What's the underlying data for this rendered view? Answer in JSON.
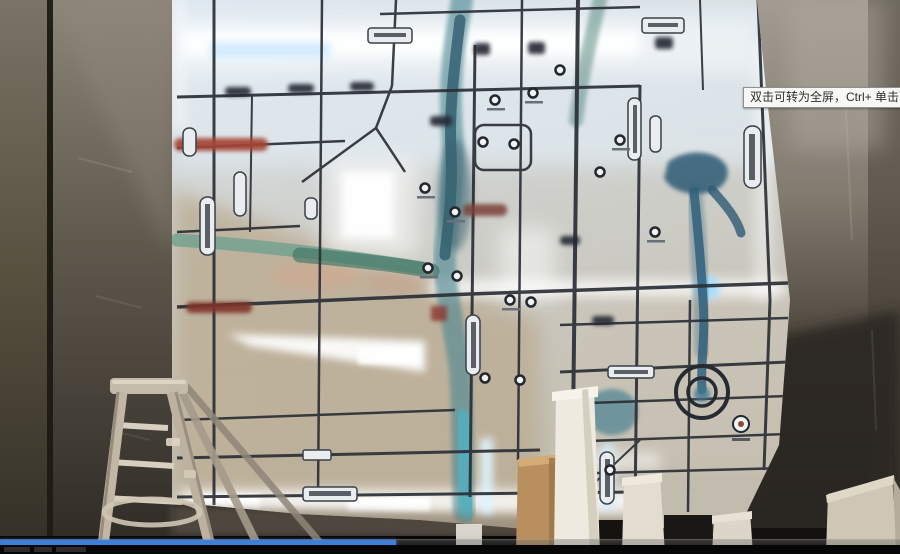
{
  "player": {
    "fullscreen_tooltip": "双击可转为全屏，Ctrl+ 单击可转为",
    "progress_percent": 44,
    "progress_color": "#3f7ed6"
  },
  "scene": {
    "subject": "illuminated-led-map-wall-with-ladder",
    "led_glow_color": "#eaf6ff",
    "river_color": "#3d7186",
    "map_board_color": "#d9dfe3",
    "concrete_wall_color": "#6e6760"
  }
}
